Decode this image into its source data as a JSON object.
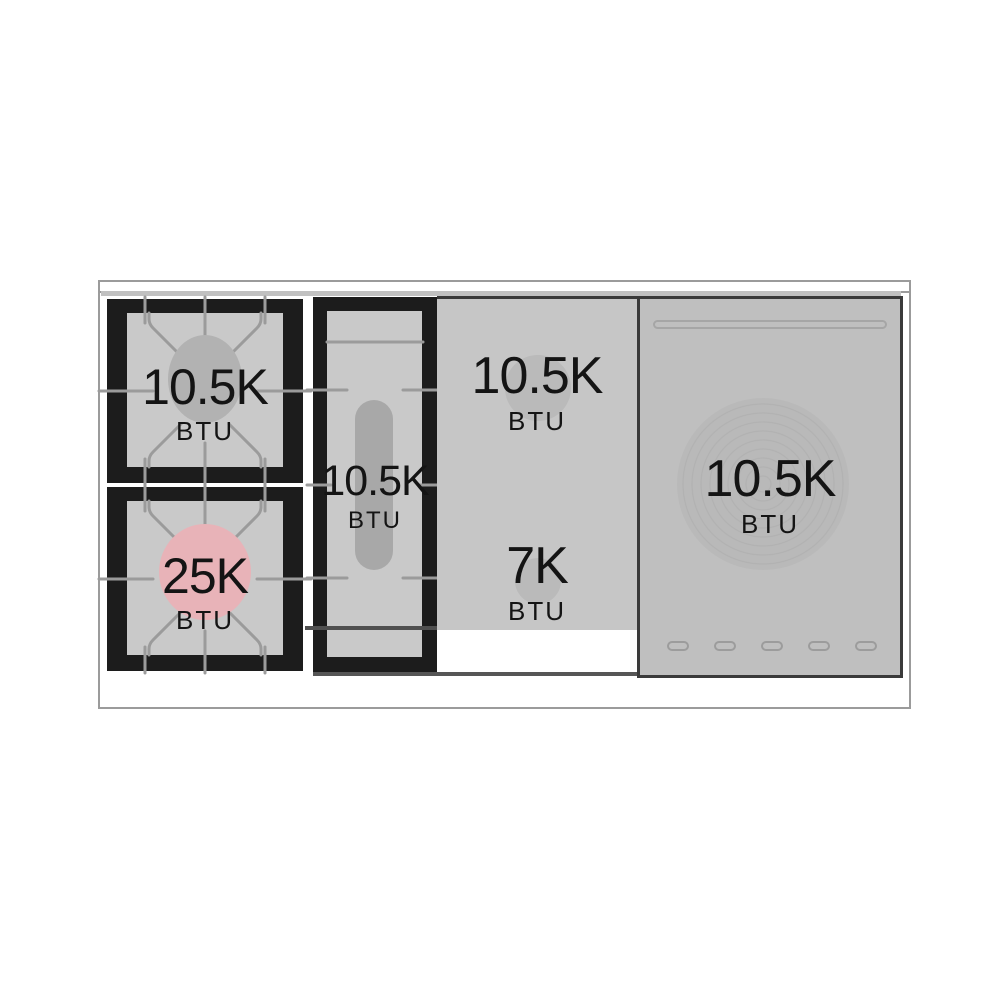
{
  "burners": {
    "left_back": {
      "power": "10.5K",
      "unit": "BTU"
    },
    "left_front": {
      "power": "25K",
      "unit": "BTU"
    },
    "center_oval": {
      "power": "10.5K",
      "unit": "BTU"
    },
    "griddle_back": {
      "power": "10.5K",
      "unit": "BTU"
    },
    "griddle_front": {
      "power": "7K",
      "unit": "BTU"
    },
    "french_top": {
      "power": "10.5K",
      "unit": "BTU"
    }
  },
  "colors": {
    "power_burner_highlight": "#e8b3b8",
    "burner_center_gray": "#b2b2b2",
    "grate_frame_black": "#1c1c1c",
    "surface_gray": "#c6c6c6",
    "panel_gray": "#bfbfbf",
    "outline_gray": "#9b9b9b"
  }
}
